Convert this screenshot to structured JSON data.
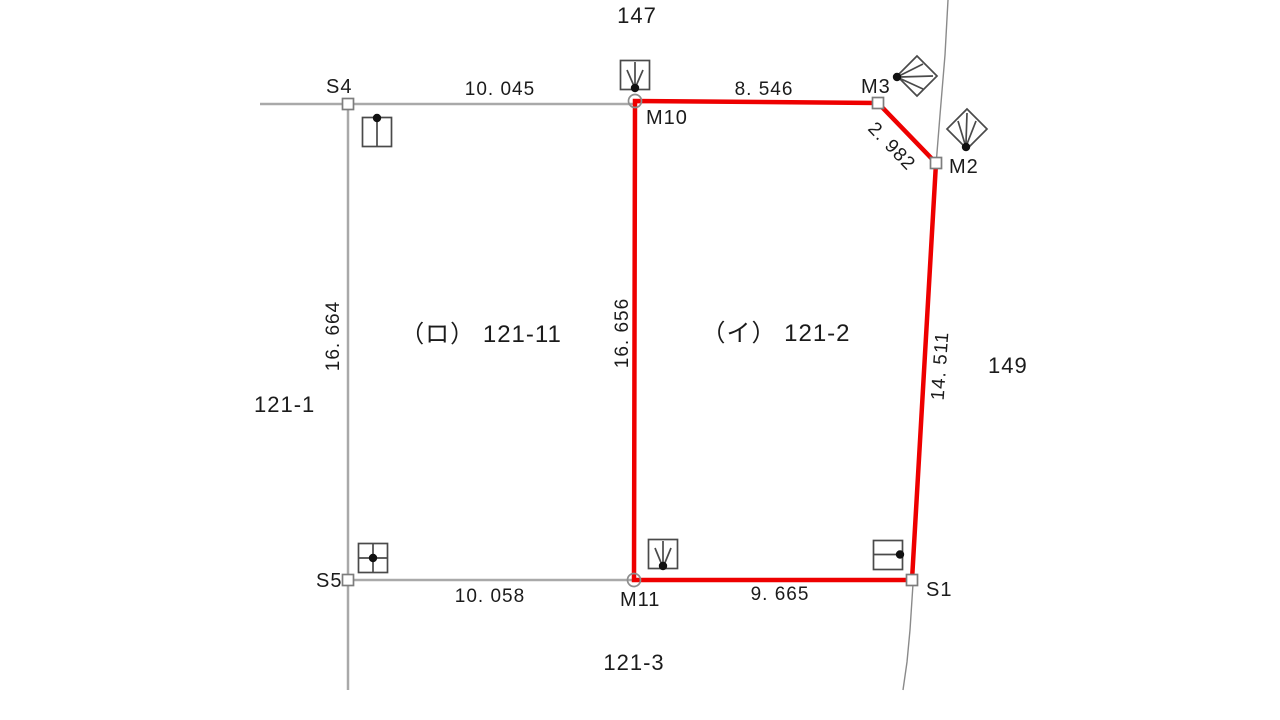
{
  "colors": {
    "parcel_outline": "#ee0000",
    "survey_line": "#a9a9a9",
    "boundary_line": "#8a8a8a",
    "symbol_stroke": "#4a4a4a",
    "text": "#1b1b1b",
    "background": "#ffffff"
  },
  "lots": {
    "north": "147",
    "east": "149",
    "west": "121-1",
    "south": "121-3",
    "left_parcel": "（ロ） 121-11",
    "right_parcel": "（イ） 121-2"
  },
  "points": {
    "s4": "S4",
    "s5": "S5",
    "s1": "S1",
    "m2": "M2",
    "m3": "M3",
    "m10": "M10",
    "m11": "M11"
  },
  "dimensions": {
    "s4_m10": "10. 045",
    "m10_m3": "8. 546",
    "m3_m2": "2. 982",
    "m2_s1": "14. 511",
    "s1_m11": "9. 665",
    "s5_m11": "10. 058",
    "m10_m11": "16. 656",
    "s4_s5": "16. 664"
  }
}
